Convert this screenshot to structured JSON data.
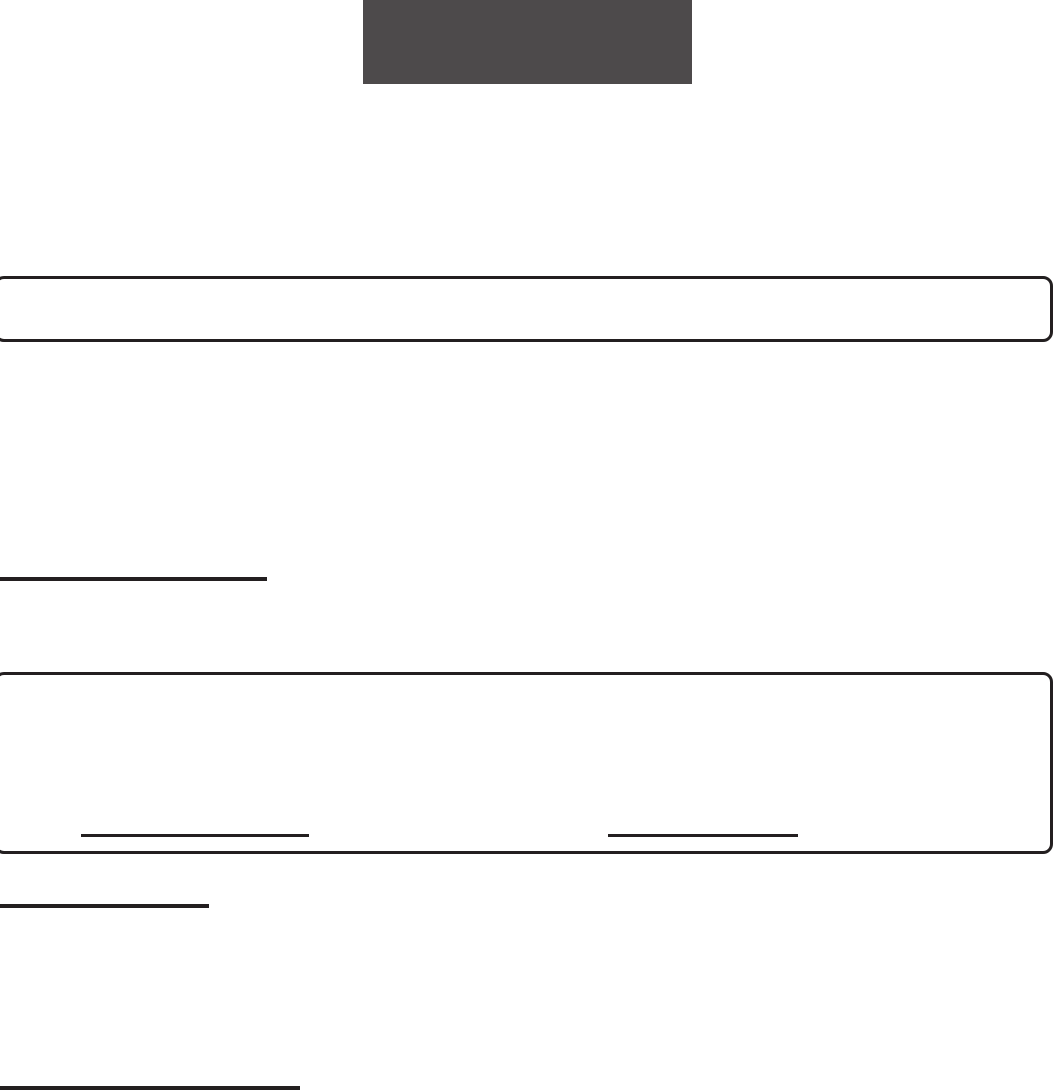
{
  "colors": {
    "page-bg": "#ffffff",
    "ink": "#231f20",
    "logo-gray": "#4d4a4b"
  },
  "document": {
    "logo_block": {
      "text": ""
    },
    "outlined_boxes": [
      {
        "text": ""
      },
      {
        "text": ""
      }
    ],
    "blank_lines": [
      {
        "text": ""
      },
      {
        "text": ""
      },
      {
        "text": ""
      },
      {
        "text": ""
      },
      {
        "text": ""
      }
    ]
  }
}
